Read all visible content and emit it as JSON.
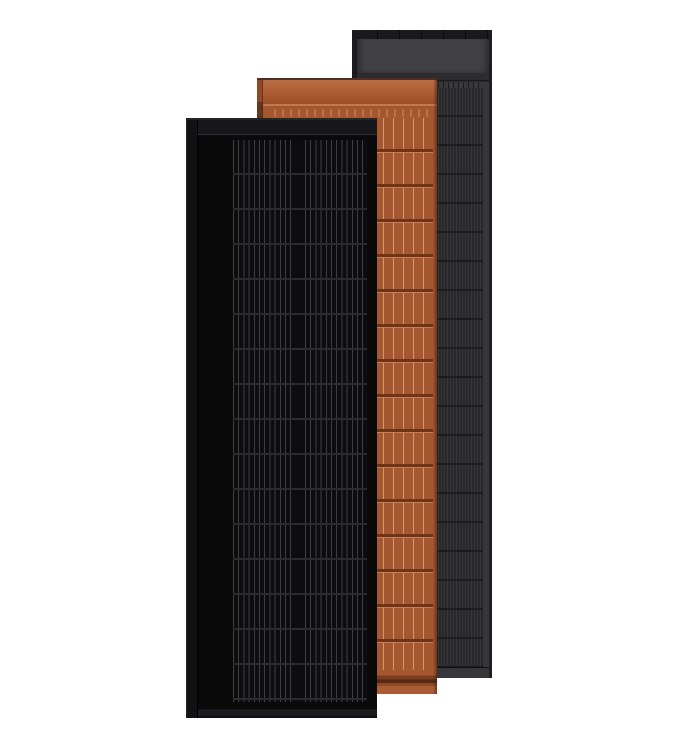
{
  "scene": {
    "background_color": "#ffffff"
  },
  "panels": {
    "black": {
      "name": "front-black-solar-panel",
      "colors": {
        "body": "#0a0a0b",
        "rail": "#121214",
        "header": "#17171a",
        "seam": "#2e2e33",
        "cell-base": "#0d0d0f",
        "cell-line": "#3e3e43",
        "row-line": "#2b2b30",
        "frame": "#1b1b1f",
        "bevel": "#3a3a3f"
      }
    },
    "terracotta": {
      "name": "middle-terracotta-solar-panel",
      "colors": {
        "base": "#a5572f",
        "header": "#ab5c33",
        "highlight": "#b96e44",
        "hiline": "#c07a50",
        "tick": "#bd7149",
        "rail": "#8d4a28",
        "railline": "#6e3318",
        "row-dark": "#6f3317",
        "row-light": "#c58058",
        "cell-line": "#d8966e",
        "footer-dark1": "#7e3c1f",
        "footer-dark2": "#572914",
        "footer-mid": "#8a4a28",
        "footer-light": "#aa5d35",
        "topline": "#4a3027"
      }
    },
    "gray": {
      "name": "back-gray-solar-panel",
      "colors": {
        "body": "#2b2b2e",
        "cap": "#1a1a1d",
        "header": "#414145",
        "groove": "#2c2c2f",
        "rail": "#38383c",
        "cell-base": "#28282b",
        "cell-stripe": "#38383c",
        "row-line": "#1d1d20",
        "frame": "#37373b",
        "edge": "#1b1b1e",
        "edge-right": "#1f1f23"
      }
    }
  }
}
